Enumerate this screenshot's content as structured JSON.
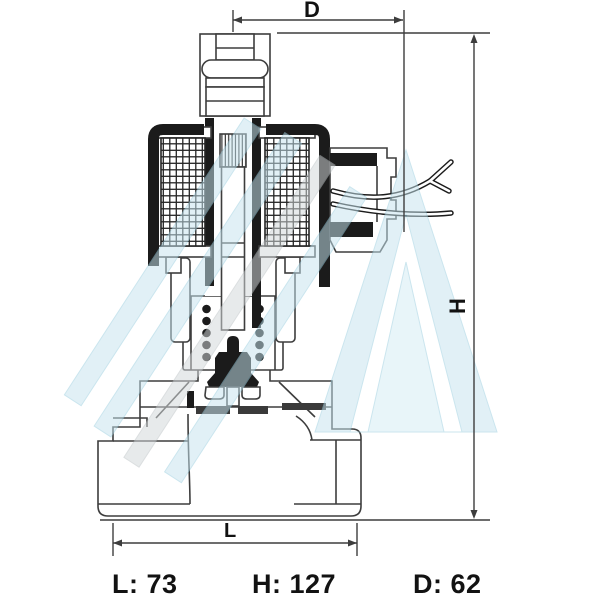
{
  "drawing": {
    "dimension_labels": {
      "d": "D",
      "h": "H",
      "l": "L"
    },
    "specs": {
      "l": "L: 73",
      "h": "H: 127",
      "d": "D: 62"
    },
    "dimension_values": {
      "L": 73,
      "H": 127,
      "D": 62
    }
  },
  "colors": {
    "line": "#3d3d3d",
    "solid": "#1b1b1b",
    "watermark": "#c6e4ef",
    "watermark_edge": "#9ccfe0",
    "text": "#121212",
    "background": "#ffffff"
  }
}
